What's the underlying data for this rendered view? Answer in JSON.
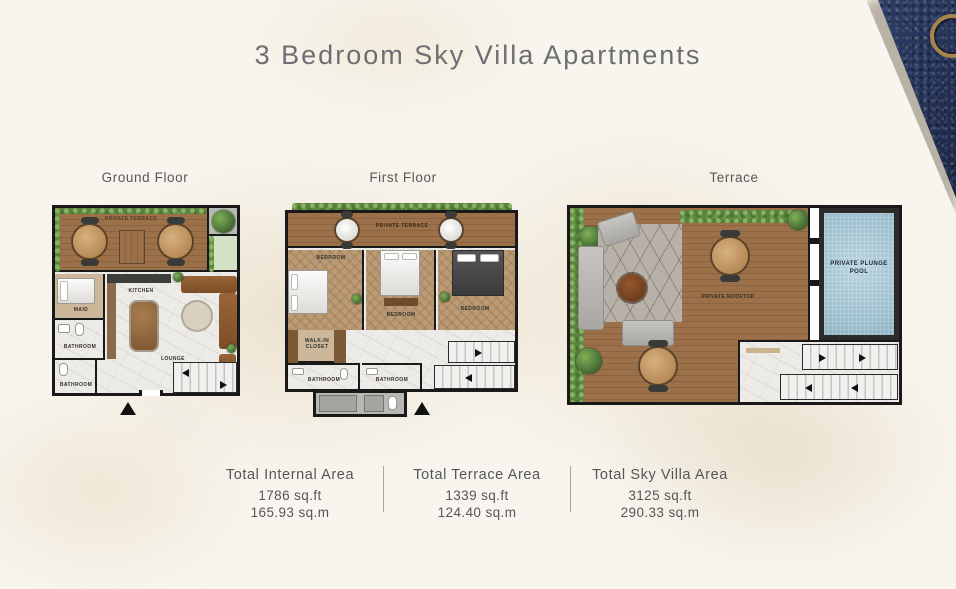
{
  "title": "3 Bedroom Sky Villa Apartments",
  "floors": [
    {
      "label": "Ground Floor",
      "rooms": {
        "private_terrace": "PRIVATE TERRACE",
        "maid": "MAID",
        "kitchen": "KITCHEN",
        "bathroom_1": "BATHROOM",
        "bathroom_2": "BATHROOM",
        "lounge": "LOUNGE"
      }
    },
    {
      "label": "First Floor",
      "rooms": {
        "private_terrace": "PRIVATE TERRACE",
        "bedroom_1": "BEDROOM",
        "bedroom_2": "BEDROOM",
        "bedroom_3": "BEDROOM",
        "walk_in_closet": "WALK-IN CLOSET",
        "bathroom_1": "BATHROOM",
        "bathroom_2": "BATHROOM"
      }
    },
    {
      "label": "Terrace",
      "rooms": {
        "private_rooftop": "PRIVATE ROOFTOP",
        "private_plunge_pool": "PRIVATE PLUNGE POOL"
      }
    }
  ],
  "areas": [
    {
      "label": "Total Internal Area",
      "sqft": "1786 sq.ft",
      "sqm": "165.93 sq.m"
    },
    {
      "label": "Total Terrace Area",
      "sqft": "1339 sq.ft",
      "sqm": "124.40 sq.m"
    },
    {
      "label": "Total Sky Villa Area",
      "sqft": "3125 sq.ft",
      "sqm": "290.33 sq.m"
    }
  ],
  "colors": {
    "navy_leather": "#26345a",
    "gold_accent": "#a9854b",
    "title_text": "#6d6e71",
    "label_text": "#57585c",
    "wall": "#191919",
    "wood_deck": "#9c7149",
    "bedroom_floor": "#bb9b74",
    "pool_water": "#a9c8d5"
  }
}
